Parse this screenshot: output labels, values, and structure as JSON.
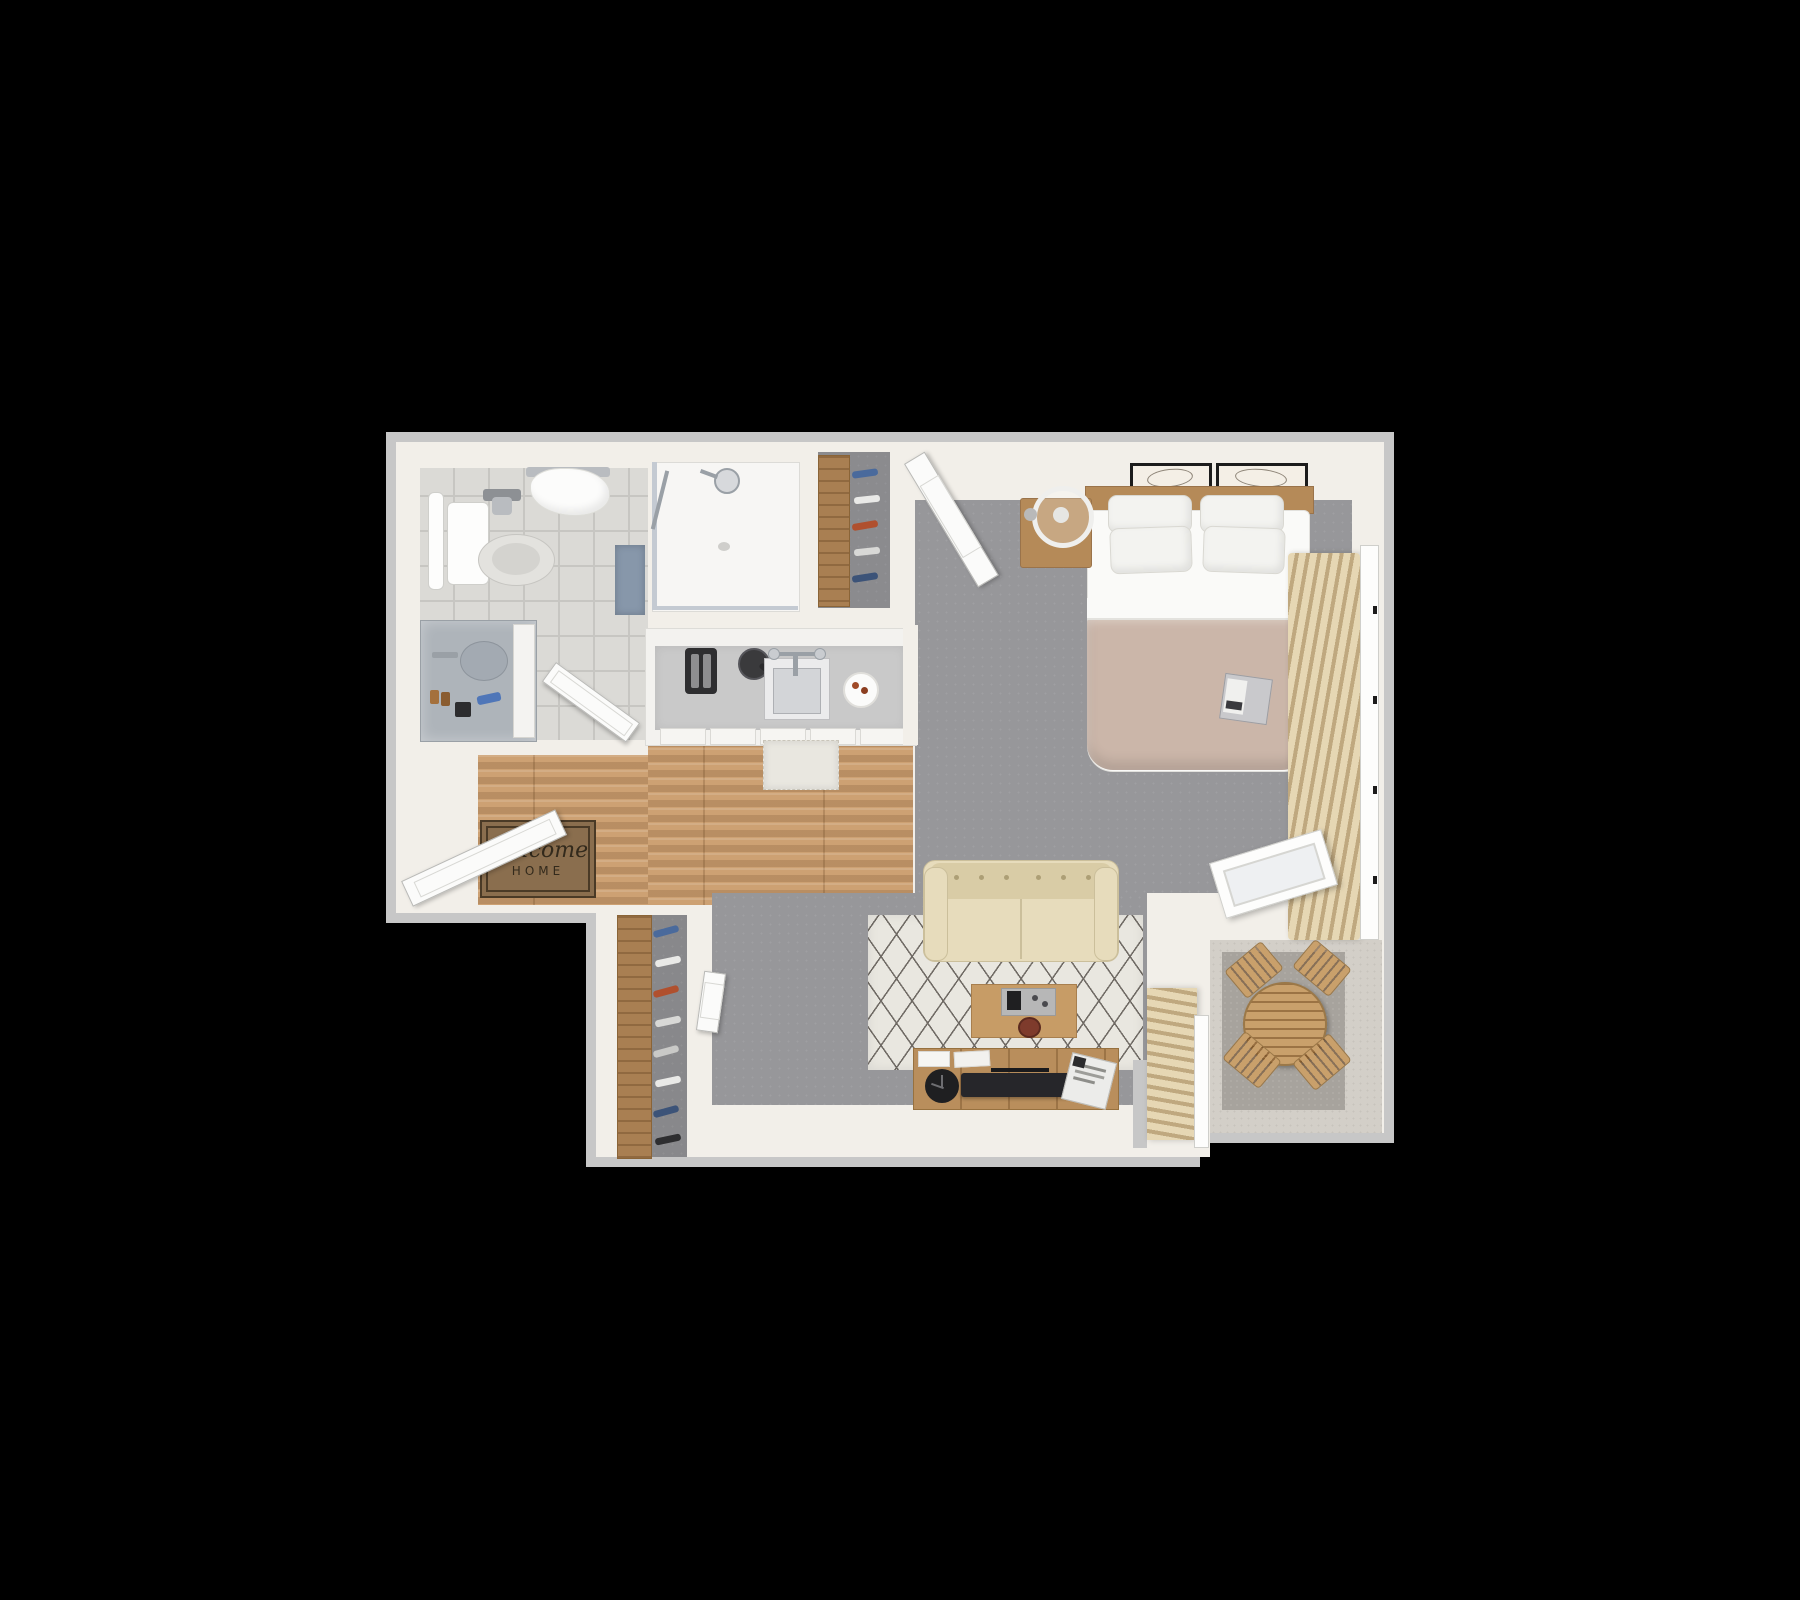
{
  "title": "3D studio apartment floor plan on black background",
  "doormat": {
    "line1": "Welcome",
    "line2": "HOME"
  },
  "legend": {
    "rooms": [
      "bathroom",
      "shower",
      "hall-closet",
      "kitchen",
      "entry",
      "bedroom",
      "living-area",
      "entry-closet",
      "balcony"
    ],
    "furniture": [
      "toilet",
      "vanity-sink",
      "shower-head",
      "bath-mat",
      "towel-rack",
      "kitchen-counter",
      "kitchen-sink",
      "toaster",
      "kettle",
      "plate",
      "kitchen-rug",
      "doormat",
      "bed",
      "headboard",
      "pillows",
      "duvet",
      "book",
      "nightstand",
      "ring-lamp",
      "wall-art",
      "vertical-blinds",
      "window",
      "sofa",
      "area-rug",
      "coffee-table",
      "tv-console",
      "tv",
      "speaker-clock",
      "magazines",
      "shoe-shelf",
      "patio-table",
      "patio-chairs",
      "sliding-door"
    ]
  },
  "palette": {
    "bg": "#000000",
    "outer_wall": "#c7c7c7",
    "wall": "#f2efe9",
    "tile": "#dbdad6",
    "tile_line": "#c7c6c2",
    "shower_floor": "#f7f6f4",
    "wood": "#cda173",
    "carpet": "#97979a",
    "rug": "#e9e7e0",
    "rug_line": "#6f6a64",
    "sofa": "#e7dcbc",
    "sofa_dark": "#d9cca6",
    "table_wood": "#c79c66",
    "console_wood": "#b98e5c",
    "shelf_wood": "#a97f52",
    "frame_wood": "#b58a58",
    "patio_wood": "#c9a06b",
    "tv_black": "#26262a",
    "duvet": "#cbb6a9",
    "sheet": "#fafaf8",
    "pillow": "#f3f3f0",
    "balcony_floor": "#d3cfc8",
    "balcony_mat": "#a7a39d",
    "blinds_light": "#e6d7b4",
    "blinds_dark": "#bfa87f",
    "mat_blue": "#8797aa",
    "marble": "#aeb4ba",
    "doormat_bg": "#8a6e4e",
    "doormat_text": "#332a1c",
    "chrome": "#9aa0a6",
    "appliance_black": "#2e2e30"
  }
}
